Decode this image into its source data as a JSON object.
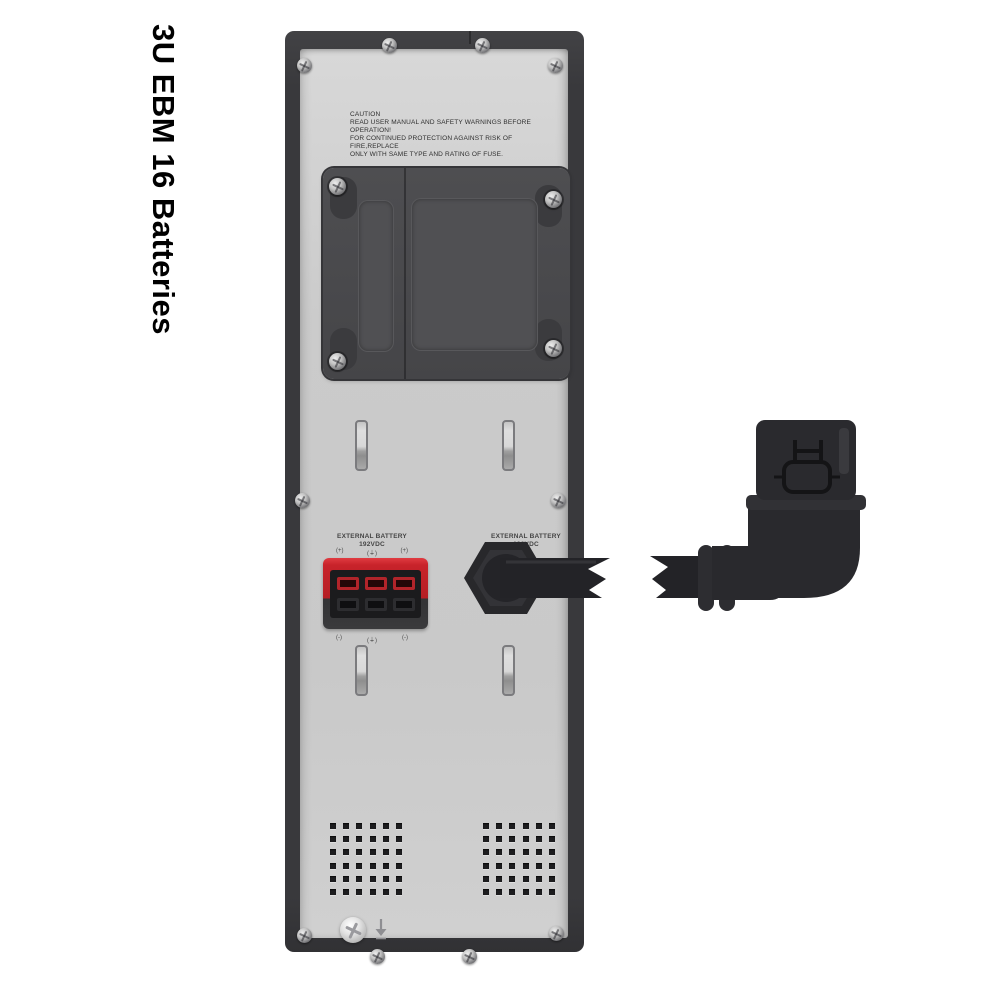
{
  "title": {
    "text": "3U EBM 16 Batteries"
  },
  "caution": {
    "lines": [
      "CAUTION",
      "READ USER MANUAL AND SAFETY WARNINGS BEFORE OPERATION!",
      "FOR CONTINUED PROTECTION AGAINST RISK OF FIRE,REPLACE",
      "ONLY WITH SAME TYPE AND RATING OF FUSE."
    ]
  },
  "terminals": {
    "left": {
      "label_line1": "EXTERNAL BATTERY",
      "label_line2": "192VDC",
      "marks_top": [
        "(+)",
        "(⏚)",
        "(+)"
      ],
      "marks_bottom": [
        "(-)",
        "(⏚)",
        "(-)"
      ]
    },
    "right": {
      "label_line1": "EXTERNAL BATTERY",
      "label_line2": "192VDC"
    }
  },
  "vents": {
    "rows": 6,
    "cols": 6
  },
  "colors": {
    "accent_red": "#c2222a",
    "panel_gray": "#cbcbcb",
    "frame_dark": "#3a3a3c",
    "connector_black": "#29292d",
    "background": "#ffffff"
  }
}
